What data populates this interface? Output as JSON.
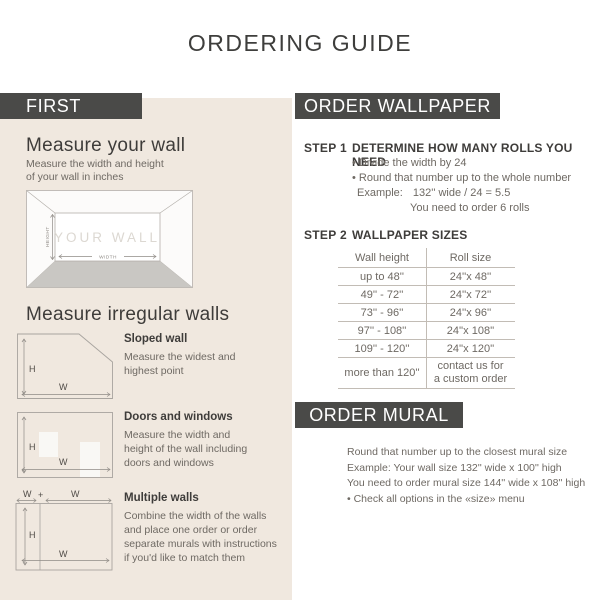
{
  "title": "ORDERING GUIDE",
  "left": {
    "header": "FIRST",
    "measure_wall": {
      "heading": "Measure your wall",
      "desc": [
        "Measure the width and height",
        "of your wall in inches"
      ]
    },
    "wall_diagram": {
      "wall_label": "YOUR WALL",
      "height_label": "HEIGHT",
      "width_label": "WIDTH"
    },
    "irregular": {
      "heading": "Measure irregular walls",
      "labels": {
        "h": "H",
        "w": "W",
        "plus": "+"
      },
      "items": [
        {
          "title": "Sloped wall",
          "lines": [
            "Measure the widest and",
            "highest point"
          ]
        },
        {
          "title": "Doors and windows",
          "lines": [
            "Measure the width and",
            "height of the wall including",
            "doors and windows"
          ]
        },
        {
          "title": "Multiple walls",
          "lines": [
            "Combine the width of the walls",
            "and place one order or order",
            "separate murals with instructions",
            "if you'd like to match them"
          ]
        }
      ]
    }
  },
  "wallpaper": {
    "header": "ORDER WALLPAPER",
    "step1": {
      "label": "STEP 1",
      "title": "DETERMINE HOW MANY ROLLS YOU NEED",
      "bullets": [
        "• Divide the width by 24",
        "• Round that number up to the whole number"
      ],
      "example_label": "Example:",
      "example_value": "132'' wide / 24 = 5.5",
      "example_result": "You need to order 6 rolls"
    },
    "step2": {
      "label": "STEP 2",
      "title": "WALLPAPER SIZES",
      "table": {
        "headers": [
          "Wall height",
          "Roll size"
        ],
        "rows": [
          {
            "height": "up to 48''",
            "roll": "24''x 48''"
          },
          {
            "height": "49'' - 72''",
            "roll": "24''x 72''"
          },
          {
            "height": "73'' - 96''",
            "roll": "24''x 96''"
          },
          {
            "height": "97'' - 108''",
            "roll": "24''x 108''"
          },
          {
            "height": "109'' - 120''",
            "roll": "24''x 120''"
          },
          {
            "height": "more than 120''",
            "roll_line1": "contact us for",
            "roll_line2": "a custom order"
          }
        ]
      }
    }
  },
  "mural": {
    "header": "ORDER MURAL",
    "lines": [
      "Round that number up to the closest mural size",
      "Example: Your wall size 132'' wide x 100'' high",
      "You need to order mural size 144'' wide x 108'' high",
      "• Check all options in the «size» menu"
    ]
  },
  "colors": {
    "bar_background": "#4a4a48",
    "panel_background": "#f0e8df",
    "heading_text": "#3e3c3a",
    "body_text": "#6e6963",
    "table_line": "#c2bcb5",
    "floor_gray": "#c9c7c3"
  }
}
